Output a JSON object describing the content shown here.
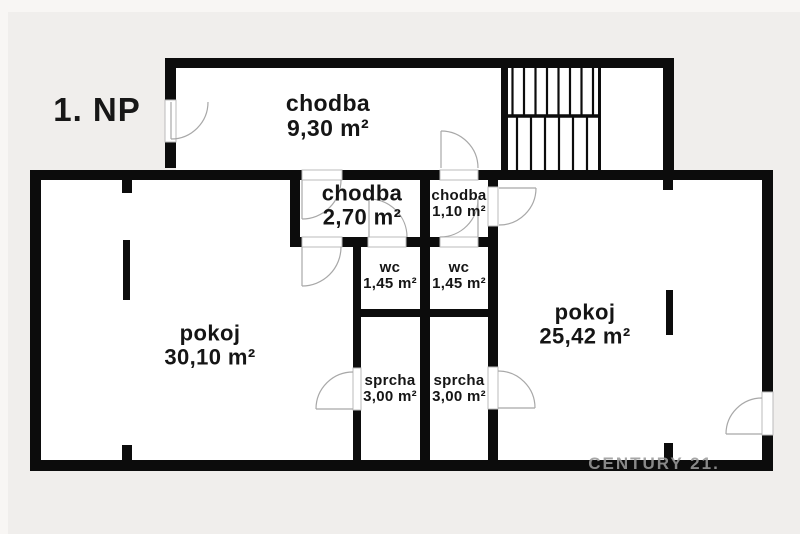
{
  "floor_plan": {
    "floor_label": "1. NP",
    "watermark": "CENTURY 21.",
    "rooms": [
      {
        "id": "chodba-main",
        "name": "chodba",
        "area": "9,30 m²"
      },
      {
        "id": "chodba-2",
        "name": "chodba",
        "area": "2,70 m²"
      },
      {
        "id": "chodba-1",
        "name": "chodba",
        "area": "1,10 m²"
      },
      {
        "id": "wc-left",
        "name": "wc",
        "area": "1,45 m²"
      },
      {
        "id": "wc-right",
        "name": "wc",
        "area": "1,45 m²"
      },
      {
        "id": "pokoj-left",
        "name": "pokoj",
        "area": "30,10 m²"
      },
      {
        "id": "pokoj-right",
        "name": "pokoj",
        "area": "25,42 m²"
      },
      {
        "id": "sprcha-left",
        "name": "sprcha",
        "area": "3,00 m²"
      },
      {
        "id": "sprcha-right",
        "name": "sprcha",
        "area": "3,00 m²"
      }
    ],
    "colors": {
      "background": "#f0eeec",
      "wall": "#0c0c0c",
      "floor": "#ffffff",
      "door_line": "#a8a8a8",
      "watermark": "#9a9a9a"
    }
  }
}
